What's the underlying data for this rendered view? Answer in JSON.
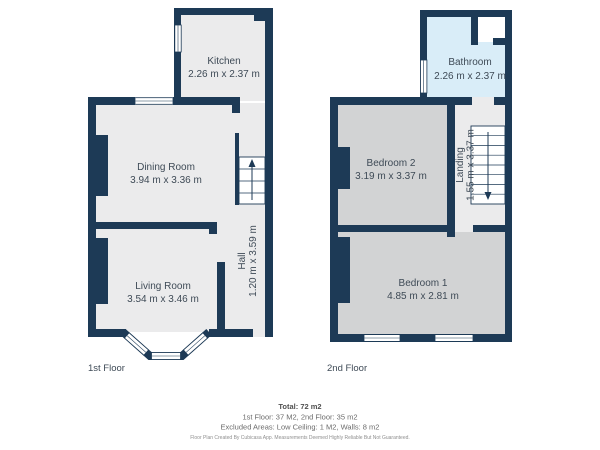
{
  "colors": {
    "wall": "#1d3a56",
    "floor_fill": "#ebebec",
    "bedroom_fill": "#d2d3d4",
    "bathroom_fill": "#d9edf8",
    "label_text": "#3e4a56",
    "footer_text": "#6b6b6b"
  },
  "floor1": {
    "label": "1st Floor",
    "kitchen": {
      "name": "Kitchen",
      "dims": "2.26 m x 2.37 m"
    },
    "dining": {
      "name": "Dining Room",
      "dims": "3.94 m x 3.36 m"
    },
    "living": {
      "name": "Living Room",
      "dims": "3.54 m x 3.46 m"
    },
    "hall": {
      "name": "Hall",
      "dims": "1.20 m x 3.59 m"
    }
  },
  "floor2": {
    "label": "2nd Floor",
    "bathroom": {
      "name": "Bathroom",
      "dims": "2.26 m x 2.37 m"
    },
    "bedroom2": {
      "name": "Bedroom 2",
      "dims": "3.19 m x 3.37 m"
    },
    "bedroom1": {
      "name": "Bedroom 1",
      "dims": "4.85 m x 2.81 m"
    },
    "landing": {
      "name": "Landing",
      "dims": "1.55 m x 3.37 m"
    }
  },
  "footer": {
    "total": "Total: 72 m2",
    "floors_line": "1st Floor: 37 M2, 2nd Floor: 35 m2",
    "excluded_line": "Excluded Areas: Low Ceiling: 1 M2, Walls: 8 m2",
    "disclaimer": "Floor Plan Created By Cubicasa App. Measurements Deemed Highly Reliable But Not Guaranteed."
  }
}
